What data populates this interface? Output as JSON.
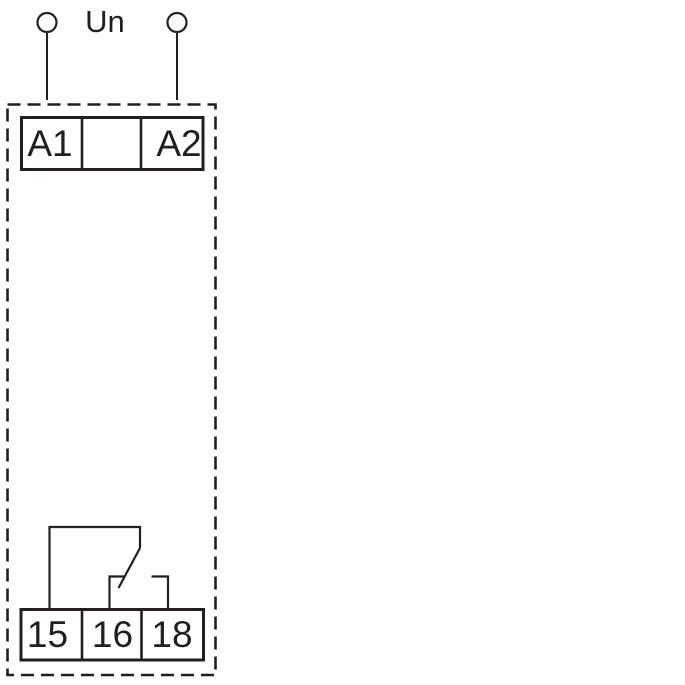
{
  "diagram": {
    "kind": "relay-wiring-diagram",
    "supply": {
      "label": "Un",
      "left_terminal_icon": "circle-outline",
      "right_terminal_icon": "circle-outline"
    },
    "top_terminal_block": {
      "cells": [
        "A1",
        "",
        "A2"
      ]
    },
    "bottom_terminal_block": {
      "cells": [
        "15",
        "16",
        "18"
      ]
    },
    "colors": {
      "line": "#231f20",
      "background": "#ffffff"
    }
  }
}
